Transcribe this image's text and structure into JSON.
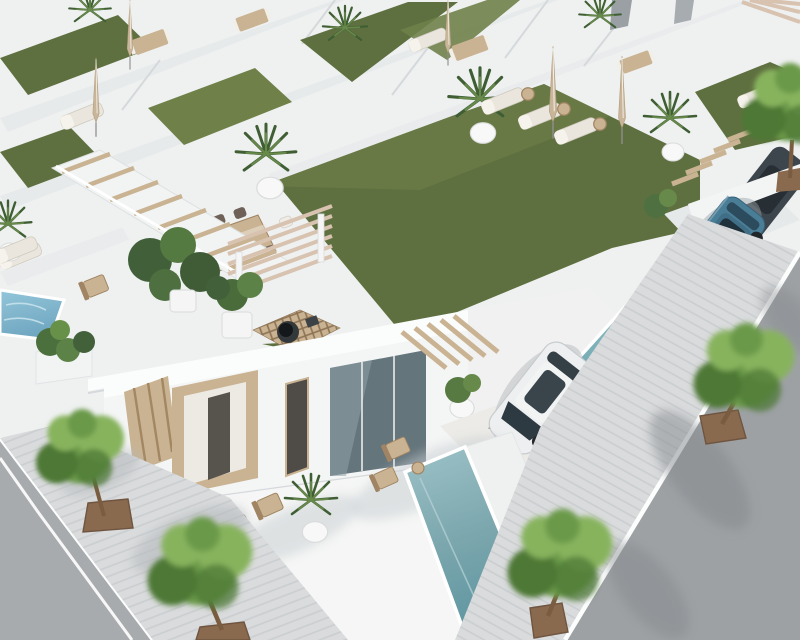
{
  "scene": {
    "type": "3d-architectural-render",
    "view": "aerial-oblique",
    "description": "Aerial 3D render of a development of identical modern white villas with rooftop solariums of artificial grass, sun loungers, closed parasols, outdoor dining sets, a latticed wood deck with fire bowl, private rectangular pools, wooden pergolas and stairs, a blue SUV and a white sedan parked in driveways, and tree-lined sidewalks along gray asphalt streets.",
    "visible_objects": {
      "villas": "rows of identical white villas receding diagonally",
      "pools": 3,
      "street_trees": 6,
      "rooftop_palms": 3,
      "cars": {
        "blue_suv": 1,
        "white_sedan": 1,
        "dark_car_partially_hidden": 1
      }
    },
    "labels": {
      "render": "aerial render of white villa development",
      "background_villas": "background rows of villas with roof terraces",
      "hero_roof": "rooftop solarium with artificial grass",
      "dining_set": "outdoor dining table with chairs",
      "fire_deck": "latticed wood deck with fire bowl",
      "roof_loungers": "sun loungers with side tables",
      "hero_facade": "villa facade with wood slat panel and door frame",
      "white_car": "white sedan in driveway",
      "blue_suv": "blue SUV in carport",
      "front_pool": "long private pool",
      "right_pool": "private pool of right villa",
      "small_pool": "small plunge pool",
      "left_street": "asphalt street with white edge line",
      "right_street": "asphalt street with tree shadows",
      "sidewalk": "paved sidewalk with street trees",
      "tree": "street tree in square planter",
      "pergola": "wooden pergola",
      "stairs": "staircase with wooden treads"
    }
  },
  "colors": {
    "base": "#eff1f1",
    "wall_bright": "#fbfcfc",
    "wall": "#f4f5f5",
    "wall_shade": "#e7eaeb",
    "wall_deep": "#d6dadc",
    "line": "#d5d9db",
    "grass": "#5f7040",
    "grass_light": "#6f8149",
    "grass_dark": "#4e6034",
    "pool_light": "#9cc2c7",
    "pool": "#7ba6ad",
    "pool_deep": "#5f96a1",
    "pool_blue": "#82b5cb",
    "wood": "#c9b392",
    "wood_light": "#dcCBab",
    "wood_dark": "#a08463",
    "beam": "#d8c2b0",
    "street": "#a8abae",
    "street_dark": "#9da1a4",
    "asphalt_shadow": "#84888c",
    "sidewalk": "#d9dbdc",
    "stripe": "#cbced0",
    "curb": "#fcfdfd",
    "tree_green": "#6a9a4a",
    "tree_light": "#87b35d",
    "tree_dark": "#4e7836",
    "palm": "#3f5e34",
    "palm_light": "#67894a",
    "planter": "#8a6a4f",
    "trunk": "#7a5c40",
    "car_blue": "#4a7e97",
    "car_blue_dark": "#223844",
    "car_white": "#edeff0",
    "glass": "#65757c",
    "glass_dark": "#333e44",
    "cushion": "#eae6dd",
    "parasol": "#c9b69a",
    "firepit": "#33383b",
    "shadow_soft": "#c7cdd1"
  }
}
